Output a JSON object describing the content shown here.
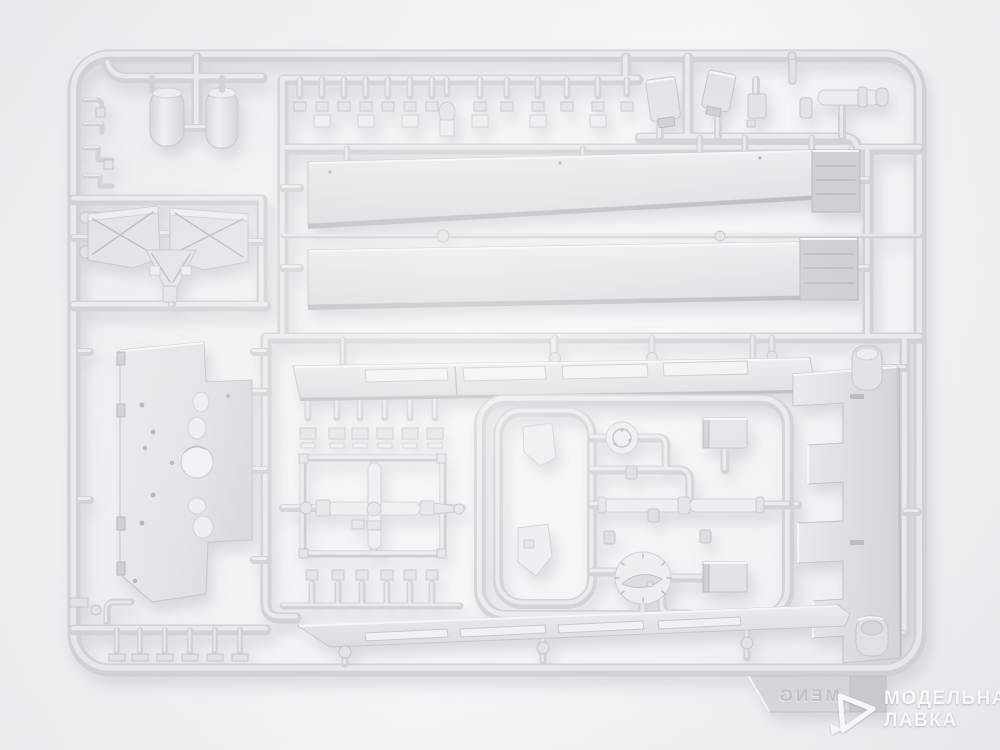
{
  "photo": {
    "type": "product-photo",
    "subject": "Light grey injection-molded plastic sprue (model kit parts frame) on white background",
    "plastic_color_name": "light grey"
  },
  "sprue": {
    "brand_embossed": "MENG",
    "embossed_mirrored": true
  },
  "watermark": {
    "line1": "МОДЕЛЬНАЯ",
    "line2": "ЛАВКА",
    "logo": "triangle-logo",
    "color": "#ffffff"
  },
  "palette": {
    "background": "#f2f1f5",
    "plastic": "#dedde2",
    "plastic_highlight": "#eeedf1",
    "plastic_shadow": "#bcbbc2",
    "panel": "#e5e4e9",
    "dark_part": "#c9c8ce"
  }
}
